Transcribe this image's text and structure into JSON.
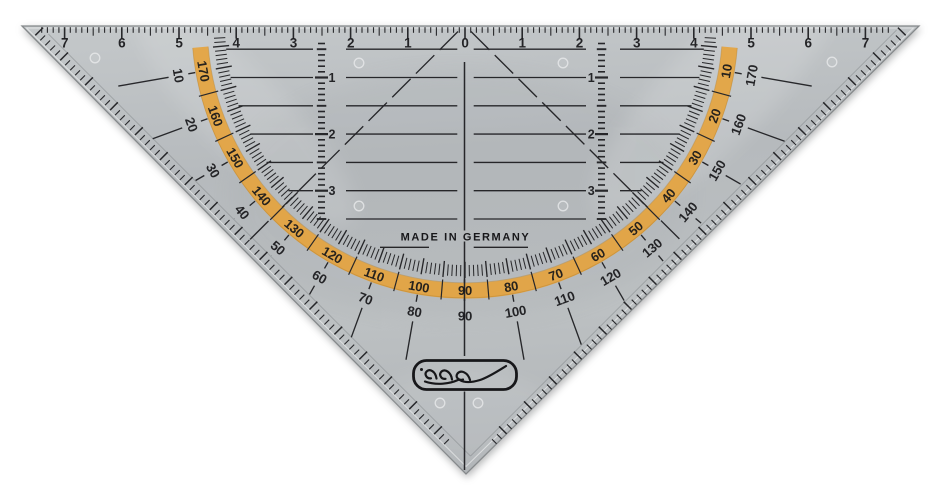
{
  "scene": {
    "background_color": "#ffffff",
    "description": "Transparent grey geometry set square (protractor triangle) photographed on white"
  },
  "colors": {
    "plastic": "#b9bdc0",
    "ink": "#17171a",
    "protractor_band": "#e6a33c",
    "band_edge": "#b57c1e"
  },
  "made_in": "MADE IN GERMANY",
  "top_ruler": {
    "unit": "cm",
    "labels": [
      {
        "text": "7",
        "cm": -7
      },
      {
        "text": "6",
        "cm": -6
      },
      {
        "text": "5",
        "cm": -5
      },
      {
        "text": "4",
        "cm": -4
      },
      {
        "text": "3",
        "cm": -3
      },
      {
        "text": "2",
        "cm": -2
      },
      {
        "text": "1",
        "cm": -1
      },
      {
        "text": "0",
        "cm": 0
      },
      {
        "text": "1",
        "cm": 1
      },
      {
        "text": "2",
        "cm": 2
      },
      {
        "text": "3",
        "cm": 3
      },
      {
        "text": "4",
        "cm": 4
      },
      {
        "text": "5",
        "cm": 5
      },
      {
        "text": "6",
        "cm": 6
      },
      {
        "text": "7",
        "cm": 7
      }
    ]
  },
  "vertical_guides": {
    "left_labels": [
      {
        "text": "1",
        "cm": 1
      },
      {
        "text": "2",
        "cm": 2
      },
      {
        "text": "3",
        "cm": 3
      }
    ],
    "right_labels": [
      {
        "text": "1",
        "cm": 1
      },
      {
        "text": "2",
        "cm": 2
      },
      {
        "text": "3",
        "cm": 3
      }
    ]
  },
  "protractor": {
    "band_scale": [
      {
        "text": "10",
        "angle": 10
      },
      {
        "text": "20",
        "angle": 20
      },
      {
        "text": "30",
        "angle": 30
      },
      {
        "text": "40",
        "angle": 40
      },
      {
        "text": "50",
        "angle": 50
      },
      {
        "text": "60",
        "angle": 60
      },
      {
        "text": "70",
        "angle": 70
      },
      {
        "text": "80",
        "angle": 80
      },
      {
        "text": "90",
        "angle": 90
      },
      {
        "text": "100",
        "angle": 100
      },
      {
        "text": "110",
        "angle": 110
      },
      {
        "text": "120",
        "angle": 120
      },
      {
        "text": "130",
        "angle": 130
      },
      {
        "text": "140",
        "angle": 140
      },
      {
        "text": "150",
        "angle": 150
      },
      {
        "text": "160",
        "angle": 160
      },
      {
        "text": "170",
        "angle": 170
      }
    ],
    "outer_scale": [
      {
        "text": "10",
        "angle": 170
      },
      {
        "text": "20",
        "angle": 160
      },
      {
        "text": "30",
        "angle": 150
      },
      {
        "text": "40",
        "angle": 140
      },
      {
        "text": "50",
        "angle": 130
      },
      {
        "text": "60",
        "angle": 120
      },
      {
        "text": "70",
        "angle": 110
      },
      {
        "text": "80",
        "angle": 100
      },
      {
        "text": "90",
        "angle": 90
      },
      {
        "text": "100",
        "angle": 80
      },
      {
        "text": "110",
        "angle": 70
      },
      {
        "text": "120",
        "angle": 60
      },
      {
        "text": "130",
        "angle": 50
      },
      {
        "text": "140",
        "angle": 40
      },
      {
        "text": "150",
        "angle": 30
      },
      {
        "text": "160",
        "angle": 20
      },
      {
        "text": "170",
        "angle": 10
      }
    ]
  },
  "logo": {
    "type": "cursive-signature-badge"
  }
}
